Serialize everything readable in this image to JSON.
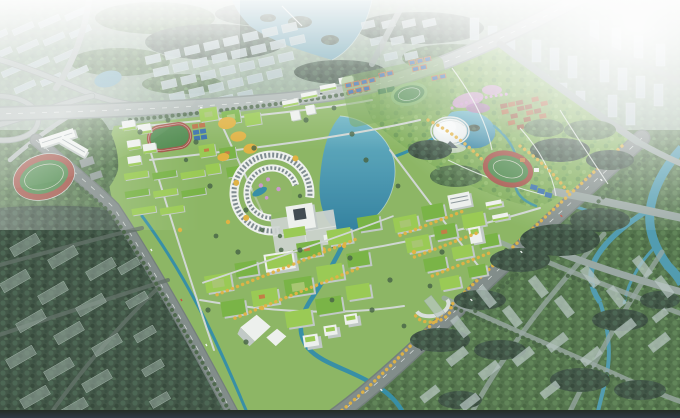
{
  "scene": {
    "title": "aerial-campus-masterplan-rendering",
    "regions": [
      "distant-city-northwest",
      "north-forest",
      "north-lake",
      "ghost-residential-grid",
      "distant-city-northeast",
      "highway-interchange",
      "northwest-pond",
      "main-boulevards",
      "west-stadium",
      "west-school-building",
      "west-campus-cluster",
      "football-pitch",
      "arc-building",
      "central-plaza-cube",
      "central-lake",
      "sports-courts-cluster",
      "green-oval-track",
      "dome-stadium",
      "dome-pond",
      "agricultural-plots",
      "northeast-park",
      "athletics-track",
      "tennis-courts",
      "east-campus-cluster",
      "south-campus-cluster",
      "context-southwest",
      "context-southeast",
      "winding-rivers",
      "haze-overlay",
      "bottom-vignette"
    ]
  },
  "palette": {
    "bldg_white": "#eef1ee",
    "bldg_shade": "#bfc8c4",
    "roof_green": "#96c94d",
    "roof_green_dark": "#74b13f",
    "roof_stripe": "#5e6e74",
    "lawn": "#88b45e",
    "park_green": "#79aa52",
    "forest_dark": "#3a5040",
    "forest_mid": "#4e7047",
    "tree_dark": "#42603f",
    "water": "#2f86a5",
    "water_light": "#63b0c2",
    "stream": "#2f8ba3",
    "shoreline": "#d6e6e3",
    "road_main": "#aab5b1",
    "road_edge": "#8c9995",
    "road_mid": "#7d8885",
    "road_dark": "#6e7a76",
    "road_ctx_light": "#96a5a0",
    "road_ctx_dark": "#5d6b62",
    "road_inner": "#cfd6d2",
    "lane_white": "#f2f6f4",
    "distant_building": "#b5c7cb",
    "distant_shade": "#8fa5aa",
    "ghost_light": "#b7c6c2",
    "ghost_dark": "#8da096",
    "track_red": "#9e4b3e",
    "pitch_green": "#468545",
    "court_blue": "#2f69a8",
    "court_orange": "#b86a3c",
    "farm_brown": "#8d4a2c",
    "farm_brown_2": "#a85c30",
    "tree_yellow": "#e0b03c",
    "flower_pink": "#cb95cc",
    "flower_purple": "#a86cb2",
    "plaza_gray": "#ccd3cf",
    "dome_white": "#eaeeee",
    "accent_orange": "#c07a3e",
    "dark_bar": "#232a22",
    "bar_navy": "#2e3844"
  }
}
